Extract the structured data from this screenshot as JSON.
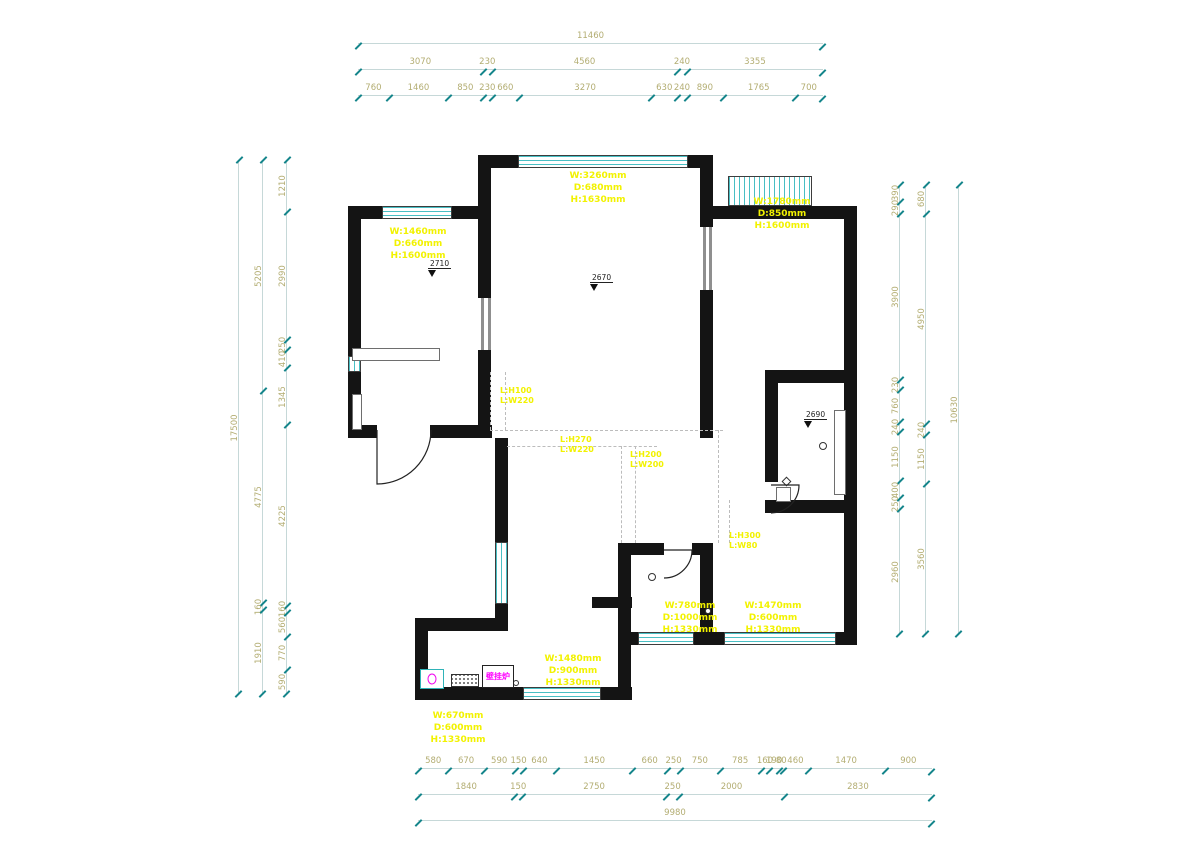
{
  "canvas": {
    "width": 1200,
    "height": 851,
    "background": "#ffffff"
  },
  "colors": {
    "wall": "#141414",
    "window_teal": "#49bfc4",
    "dim_text": "#b3ad72",
    "dim_line": "#c6d8d8",
    "dim_tick": "#14858b",
    "annotation_yellow": "#f2f200",
    "boiler_magenta": "#ff00ff"
  },
  "dimensions": {
    "top": {
      "x": 358,
      "y": 30,
      "w": 465,
      "row_gap": 26,
      "rows": [
        [
          "11460"
        ],
        [
          "3070",
          "230",
          "4560",
          "240",
          "3355"
        ],
        [
          "760",
          "1460",
          "850",
          "230",
          "660",
          "3270",
          "630",
          "240",
          "890",
          "1765",
          "700"
        ]
      ]
    },
    "bottom": {
      "x": 418,
      "y": 755,
      "w": 514,
      "row_gap": 26,
      "rows": [
        [
          "580",
          "670",
          "590",
          "150",
          "640",
          "1450",
          "660",
          "250",
          "750",
          "785",
          "160",
          "190",
          "80",
          "460",
          "1470",
          "900"
        ],
        [
          "1840",
          "150",
          "2750",
          "250",
          "2000",
          "2830"
        ],
        [
          "9980"
        ]
      ]
    },
    "left": {
      "y": 160,
      "h": 535,
      "cols": [
        {
          "x": 238,
          "values": [
            "17500"
          ]
        },
        {
          "x": 262,
          "values": [
            "5205",
            "4775",
            "160",
            "1910"
          ]
        },
        {
          "x": 286,
          "values": [
            "1210",
            "2990",
            "250",
            "410",
            "1345",
            "4225",
            "160",
            "560",
            "770",
            "590"
          ]
        }
      ]
    },
    "right": {
      "y": 185,
      "h": 450,
      "cols": [
        {
          "x": 899,
          "values": [
            "390",
            "290",
            "3900",
            "230",
            "760",
            "240",
            "1150",
            "400",
            "250",
            "2960"
          ]
        },
        {
          "x": 925,
          "values": [
            "680",
            "4950",
            "240",
            "1150",
            "3560"
          ]
        },
        {
          "x": 958,
          "values": [
            "10630"
          ]
        }
      ]
    }
  },
  "plan": {
    "walls": [
      [
        488,
        155,
        225,
        13
      ],
      [
        348,
        206,
        143,
        13
      ],
      [
        713,
        206,
        144,
        13
      ],
      [
        348,
        206,
        13,
        150
      ],
      [
        348,
        372,
        13,
        66
      ],
      [
        478,
        155,
        13,
        143
      ],
      [
        478,
        350,
        13,
        88
      ],
      [
        700,
        155,
        13,
        72
      ],
      [
        700,
        290,
        13,
        92
      ],
      [
        844,
        206,
        13,
        432
      ],
      [
        348,
        425,
        29,
        13
      ],
      [
        430,
        425,
        62,
        13
      ],
      [
        765,
        370,
        92,
        13
      ],
      [
        765,
        382,
        13,
        100
      ],
      [
        765,
        500,
        92,
        13
      ],
      [
        700,
        382,
        13,
        56
      ],
      [
        700,
        543,
        13,
        102
      ],
      [
        630,
        543,
        34,
        12
      ],
      [
        692,
        543,
        21,
        12
      ],
      [
        618,
        543,
        13,
        157
      ],
      [
        495,
        438,
        13,
        104
      ],
      [
        495,
        604,
        13,
        27
      ],
      [
        415,
        618,
        85,
        13
      ],
      [
        415,
        631,
        13,
        69
      ],
      [
        415,
        687,
        217,
        13
      ],
      [
        630,
        632,
        227,
        13
      ],
      [
        592,
        597,
        40,
        11
      ]
    ],
    "windows": [
      [
        518,
        155,
        170,
        13,
        "h"
      ],
      [
        382,
        206,
        70,
        13,
        "h"
      ],
      [
        728,
        176,
        84,
        30,
        "v"
      ],
      [
        348,
        356,
        13,
        16,
        "v"
      ],
      [
        495,
        542,
        13,
        62,
        "v"
      ],
      [
        523,
        687,
        78,
        13,
        "h"
      ],
      [
        638,
        632,
        56,
        13,
        "h"
      ],
      [
        724,
        632,
        112,
        13,
        "h"
      ]
    ],
    "thin_lines": [
      [
        481,
        298,
        3,
        52
      ],
      [
        488,
        298,
        3,
        52
      ],
      [
        703,
        227,
        3,
        63
      ],
      [
        709,
        227,
        3,
        63
      ]
    ],
    "outlines": [
      [
        352,
        348,
        88,
        13
      ],
      [
        352,
        394,
        10,
        36
      ],
      [
        834,
        410,
        12,
        85
      ],
      [
        776,
        487,
        15,
        15
      ]
    ],
    "dashes_h": [
      [
        490,
        430,
        233
      ],
      [
        507,
        446,
        150
      ]
    ],
    "dashes_v": [
      [
        490,
        372,
        58
      ],
      [
        505,
        372,
        58
      ],
      [
        621,
        446,
        97
      ],
      [
        635,
        446,
        97
      ],
      [
        718,
        430,
        113
      ],
      [
        729,
        500,
        43
      ]
    ],
    "door_paths": [
      "M377,430 L377,484 A54,54 0 0 0 431,430",
      "M771,485 L799,485 A28,28 0 0 1 771,513",
      "M664,550 L692,550 A28,28 0 0 1 664,578"
    ],
    "circles": [
      [
        652,
        577,
        4
      ],
      [
        823,
        446,
        4
      ],
      [
        516,
        683,
        3
      ],
      [
        708,
        611,
        3
      ]
    ],
    "diamonds": [
      [
        783,
        478
      ]
    ],
    "room_labels": [
      {
        "x": 418,
        "y": 226,
        "lines": [
          "W:1460mm",
          "D:660mm",
          "H:1600mm"
        ]
      },
      {
        "x": 598,
        "y": 170,
        "lines": [
          "W:3260mm",
          "D:680mm",
          "H:1630mm"
        ]
      },
      {
        "x": 782,
        "y": 196,
        "lines": [
          "W:1780mm",
          "D:850mm",
          "H:1600mm"
        ]
      },
      {
        "x": 690,
        "y": 600,
        "lines": [
          "W:780mm",
          "D:1000mm",
          "H:1330mm"
        ]
      },
      {
        "x": 773,
        "y": 600,
        "lines": [
          "W:1470mm",
          "D:600mm",
          "H:1330mm"
        ]
      },
      {
        "x": 573,
        "y": 653,
        "lines": [
          "W:1480mm",
          "D:900mm",
          "H:1330mm"
        ]
      },
      {
        "x": 458,
        "y": 710,
        "lines": [
          "W:670mm",
          "D:600mm",
          "H:1330mm"
        ]
      }
    ],
    "beam_labels": [
      {
        "x": 500,
        "y": 386,
        "lines": [
          "L:H100",
          "L:W220"
        ]
      },
      {
        "x": 560,
        "y": 435,
        "lines": [
          "L:H270",
          "L:W220"
        ]
      },
      {
        "x": 630,
        "y": 450,
        "lines": [
          "L:H200",
          "L:W200"
        ]
      },
      {
        "x": 729,
        "y": 531,
        "lines": [
          "L:H300",
          "L:W80"
        ]
      }
    ],
    "level_markers": [
      {
        "x": 428,
        "y": 260,
        "value": "2710"
      },
      {
        "x": 590,
        "y": 274,
        "value": "2670"
      },
      {
        "x": 804,
        "y": 411,
        "value": "2690"
      }
    ],
    "appliances": {
      "meter": [
        420,
        669,
        24,
        20
      ],
      "grille": [
        451,
        674,
        28,
        13
      ],
      "boiler": [
        482,
        665,
        32,
        23
      ],
      "boiler_label": "壁挂炉"
    }
  }
}
